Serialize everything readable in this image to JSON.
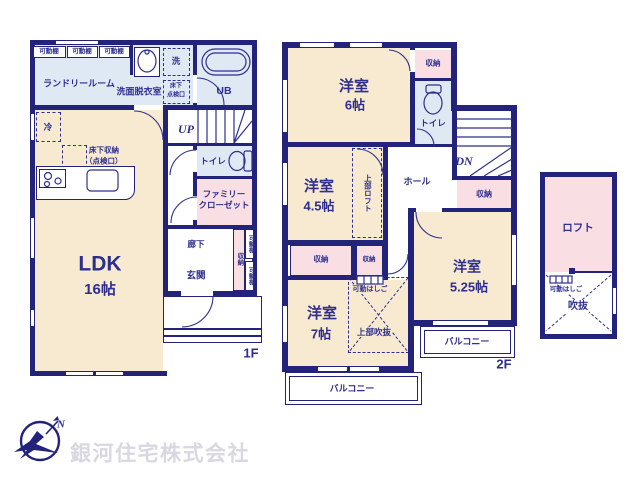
{
  "colors": {
    "wall": "#23237b",
    "ink": "#2e2e8f",
    "cream": "#f7ead0",
    "blue": "#dfe9f4",
    "pink": "#f9dfe4",
    "logo": "#d8d8e2"
  },
  "common": {
    "shelf": "可動棚",
    "storage": "収納",
    "toilet": "トイレ",
    "western_room": "洋室",
    "balcony": "バルコニー",
    "movable_ladder": "可動はしご"
  },
  "floor1": {
    "label": "1F",
    "laundry_room": "ランドリールーム",
    "washroom": "洗面脱衣室",
    "washer": "洗",
    "underfloor_hatch_line1": "床下",
    "underfloor_hatch_line2": "点検口",
    "unit_bath": "UB",
    "fridge": "冷",
    "underfloor_storage": "床下収納",
    "underfloor_storage_note": "（点検口）",
    "stairs_up": "UP",
    "family_closet_line1": "ファミリー",
    "family_closet_line2": "クローゼット",
    "hallway": "廊下",
    "entrance": "玄関",
    "ldk": "LDK",
    "ldk_size": "16帖"
  },
  "floor2": {
    "label": "2F",
    "room6_size": "6帖",
    "room45_size": "4.5帖",
    "room7_size": "7帖",
    "room525_size": "5.25帖",
    "stairs_down": "DN",
    "hall": "ホール",
    "upper_loft": "上部ロフト",
    "upper_void": "上部吹抜"
  },
  "loft": {
    "name": "ロフト",
    "void": "吹抜"
  },
  "footer": {
    "company": "銀河住宅株式会社",
    "compass_n": "N"
  }
}
